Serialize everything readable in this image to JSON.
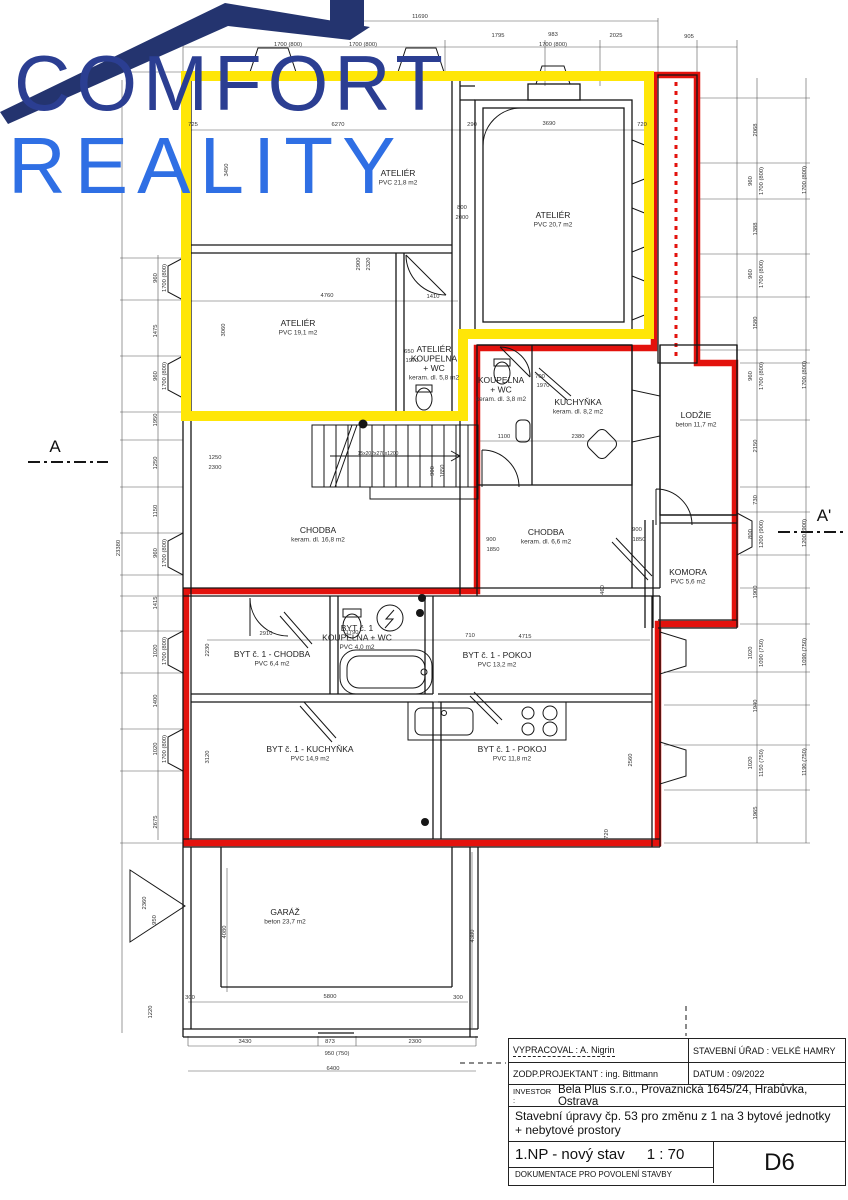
{
  "logo": {
    "line1": "COMFORT",
    "line2": "REALITY",
    "colors": {
      "comfort": "#2b3e92",
      "reality": "#2f6fe4",
      "roof": "#24346f"
    }
  },
  "highlight": {
    "yellow": "#ffe608",
    "red": "#e3120d"
  },
  "markers": {
    "left": "A",
    "right": "A'"
  },
  "rooms": [
    {
      "id": "atelier-21",
      "x": 398,
      "y": 176,
      "sub": 1,
      "lines": [
        "ATELIÉR",
        "PVC 21,8 m2"
      ]
    },
    {
      "id": "atelier-19",
      "x": 298,
      "y": 326,
      "sub": 1,
      "lines": [
        "ATELIÉR",
        "PVC 19,1 m2"
      ]
    },
    {
      "id": "atelier-20",
      "x": 553,
      "y": 218,
      "sub": 1,
      "lines": [
        "ATELIÉR",
        "PVC 20,7 m2"
      ]
    },
    {
      "id": "atelier-koupelna",
      "x": 434,
      "y": 352,
      "sub": 3,
      "lines": [
        "ATELIÉR",
        "KOUPELNA",
        "+ WC",
        "keram. dl. 5,8 m2"
      ]
    },
    {
      "id": "koupelna-wc",
      "x": 501,
      "y": 383,
      "sub": 2,
      "lines": [
        "KOUPELNA",
        "+ WC",
        "keram. dl. 3,8 m2"
      ]
    },
    {
      "id": "kuchynka",
      "x": 578,
      "y": 405,
      "sub": 1,
      "lines": [
        "KUCHYŇKA",
        "keram. dl. 8,2 m2"
      ]
    },
    {
      "id": "lodzie",
      "x": 696,
      "y": 418,
      "sub": 1,
      "lines": [
        "LODŽIE",
        "beton 11,7 m2"
      ]
    },
    {
      "id": "chodba-hlavni",
      "x": 318,
      "y": 533,
      "sub": 1,
      "lines": [
        "CHODBA",
        "keram. dl. 16,8 m2"
      ]
    },
    {
      "id": "chodba-mala",
      "x": 546,
      "y": 535,
      "sub": 1,
      "lines": [
        "CHODBA",
        "keram. dl. 6,6 m2"
      ]
    },
    {
      "id": "komora",
      "x": 688,
      "y": 575,
      "sub": 1,
      "lines": [
        "KOMORA",
        "PVC 5,6 m2"
      ]
    },
    {
      "id": "byt1-chodba",
      "x": 272,
      "y": 657,
      "sub": 1,
      "lines": [
        "BYT č. 1 - CHODBA",
        "PVC 6,4 m2"
      ]
    },
    {
      "id": "byt1-koupelna",
      "x": 357,
      "y": 631,
      "sub": 2,
      "lines": [
        "BYT č. 1",
        "KOUPELNA + WC",
        "PVC 4,0 m2"
      ]
    },
    {
      "id": "byt1-pokoj-13",
      "x": 497,
      "y": 658,
      "sub": 1,
      "lines": [
        "BYT č. 1 - POKOJ",
        "PVC 13,2 m2"
      ]
    },
    {
      "id": "byt1-kuchynka",
      "x": 310,
      "y": 752,
      "sub": 1,
      "lines": [
        "BYT č. 1 - KUCHYŇKA",
        "PVC 14,9 m2"
      ]
    },
    {
      "id": "byt1-pokoj-11",
      "x": 512,
      "y": 752,
      "sub": 1,
      "lines": [
        "BYT č. 1 - POKOJ",
        "PVC 11,8 m2"
      ]
    },
    {
      "id": "garaz",
      "x": 285,
      "y": 915,
      "sub": 1,
      "lines": [
        "GARÁŽ",
        "beton 23,7 m2"
      ]
    }
  ],
  "dims": [
    {
      "t": "11690",
      "x": 420,
      "y": 18
    },
    {
      "t": "1700 (800)",
      "x": 288,
      "y": 46
    },
    {
      "t": "1700 (800)",
      "x": 363,
      "y": 46
    },
    {
      "t": "1795",
      "x": 498,
      "y": 37
    },
    {
      "t": "983",
      "x": 553,
      "y": 36
    },
    {
      "t": "1700 (800)",
      "x": 553,
      "y": 46
    },
    {
      "t": "2025",
      "x": 616,
      "y": 37
    },
    {
      "t": "905",
      "x": 689,
      "y": 38
    },
    {
      "t": "725",
      "x": 193,
      "y": 126
    },
    {
      "t": "6270",
      "x": 338,
      "y": 126
    },
    {
      "t": "290",
      "x": 472,
      "y": 126
    },
    {
      "t": "3690",
      "x": 549,
      "y": 125
    },
    {
      "t": "720",
      "x": 642,
      "y": 126
    },
    {
      "t": "960",
      "x": 157,
      "y": 278,
      "r": 1
    },
    {
      "t": "1700 (800)",
      "x": 166,
      "y": 278,
      "r": 1
    },
    {
      "t": "1475",
      "x": 157,
      "y": 331,
      "r": 1
    },
    {
      "t": "960",
      "x": 157,
      "y": 376,
      "r": 1
    },
    {
      "t": "1700 (800)",
      "x": 166,
      "y": 376,
      "r": 1
    },
    {
      "t": "1950",
      "x": 157,
      "y": 420,
      "r": 1
    },
    {
      "t": "1250",
      "x": 157,
      "y": 463,
      "r": 1
    },
    {
      "t": "1150",
      "x": 157,
      "y": 511,
      "r": 1
    },
    {
      "t": "960",
      "x": 157,
      "y": 553,
      "r": 1
    },
    {
      "t": "1700 (800)",
      "x": 166,
      "y": 553,
      "r": 1
    },
    {
      "t": "1415",
      "x": 157,
      "y": 603,
      "r": 1
    },
    {
      "t": "1020",
      "x": 157,
      "y": 651,
      "r": 1
    },
    {
      "t": "1700 (800)",
      "x": 166,
      "y": 651,
      "r": 1
    },
    {
      "t": "1400",
      "x": 157,
      "y": 701,
      "r": 1
    },
    {
      "t": "1020",
      "x": 157,
      "y": 749,
      "r": 1
    },
    {
      "t": "1700 (800)",
      "x": 166,
      "y": 749,
      "r": 1
    },
    {
      "t": "2675",
      "x": 157,
      "y": 822,
      "r": 1
    },
    {
      "t": "23380",
      "x": 120,
      "y": 548,
      "r": 1
    },
    {
      "t": "3450",
      "x": 228,
      "y": 170,
      "r": 1
    },
    {
      "t": "3060",
      "x": 225,
      "y": 330,
      "r": 1
    },
    {
      "t": "2068",
      "x": 757,
      "y": 130,
      "r": 1
    },
    {
      "t": "960",
      "x": 752,
      "y": 181,
      "r": 1
    },
    {
      "t": "1700 (800)",
      "x": 763,
      "y": 181,
      "r": 1
    },
    {
      "t": "1388",
      "x": 757,
      "y": 229,
      "r": 1
    },
    {
      "t": "960",
      "x": 752,
      "y": 274,
      "r": 1
    },
    {
      "t": "1700 (800)",
      "x": 763,
      "y": 274,
      "r": 1
    },
    {
      "t": "1580",
      "x": 757,
      "y": 323,
      "r": 1
    },
    {
      "t": "960",
      "x": 752,
      "y": 376,
      "r": 1
    },
    {
      "t": "1700 (800)",
      "x": 763,
      "y": 376,
      "r": 1
    },
    {
      "t": "2150",
      "x": 757,
      "y": 446,
      "r": 1
    },
    {
      "t": "730",
      "x": 757,
      "y": 500,
      "r": 1
    },
    {
      "t": "800",
      "x": 752,
      "y": 534,
      "r": 1
    },
    {
      "t": "1200 (900)",
      "x": 763,
      "y": 534,
      "r": 1
    },
    {
      "t": "1900",
      "x": 757,
      "y": 592,
      "r": 1
    },
    {
      "t": "1020",
      "x": 752,
      "y": 653,
      "r": 1
    },
    {
      "t": "1090 (750)",
      "x": 763,
      "y": 653,
      "r": 1
    },
    {
      "t": "1940",
      "x": 757,
      "y": 706,
      "r": 1
    },
    {
      "t": "1020",
      "x": 752,
      "y": 763,
      "r": 1
    },
    {
      "t": "1150 (750)",
      "x": 763,
      "y": 763,
      "r": 1
    },
    {
      "t": "1965",
      "x": 757,
      "y": 813,
      "r": 1
    },
    {
      "t": "1700 (800)",
      "x": 806,
      "y": 180,
      "r": 1
    },
    {
      "t": "1700 (800)",
      "x": 806,
      "y": 375,
      "r": 1
    },
    {
      "t": "1200 (900)",
      "x": 806,
      "y": 533,
      "r": 1
    },
    {
      "t": "1090 (750)",
      "x": 806,
      "y": 652,
      "r": 1
    },
    {
      "t": "1190 (750)",
      "x": 806,
      "y": 762,
      "r": 1
    },
    {
      "t": "4760",
      "x": 327,
      "y": 297
    },
    {
      "t": "1410",
      "x": 433,
      "y": 298
    },
    {
      "t": "800",
      "x": 462,
      "y": 209
    },
    {
      "t": "2000",
      "x": 462,
      "y": 219
    },
    {
      "t": "2900",
      "x": 360,
      "y": 264,
      "r": 1
    },
    {
      "t": "2320",
      "x": 370,
      "y": 264,
      "r": 1
    },
    {
      "t": "650",
      "x": 409,
      "y": 353
    },
    {
      "t": "1970",
      "x": 412,
      "y": 362
    },
    {
      "t": "700",
      "x": 540,
      "y": 378
    },
    {
      "t": "1970",
      "x": 543,
      "y": 387
    },
    {
      "t": "1100",
      "x": 504,
      "y": 438
    },
    {
      "t": "2380",
      "x": 578,
      "y": 438
    },
    {
      "t": "1250",
      "x": 215,
      "y": 459
    },
    {
      "t": "2300",
      "x": 215,
      "y": 469
    },
    {
      "t": "900",
      "x": 434,
      "y": 471,
      "r": 1
    },
    {
      "t": "1850",
      "x": 444,
      "y": 471,
      "r": 1
    },
    {
      "t": "900",
      "x": 491,
      "y": 541
    },
    {
      "t": "1850",
      "x": 493,
      "y": 551
    },
    {
      "t": "900",
      "x": 637,
      "y": 531
    },
    {
      "t": "1850",
      "x": 639,
      "y": 541
    },
    {
      "t": "2910",
      "x": 266,
      "y": 635
    },
    {
      "t": "1790",
      "x": 352,
      "y": 634
    },
    {
      "t": "710",
      "x": 470,
      "y": 637
    },
    {
      "t": "4715",
      "x": 525,
      "y": 638
    },
    {
      "t": "460",
      "x": 604,
      "y": 590,
      "r": 1
    },
    {
      "t": "2560",
      "x": 632,
      "y": 760,
      "r": 1
    },
    {
      "t": "720",
      "x": 608,
      "y": 834,
      "r": 1
    },
    {
      "t": "2230",
      "x": 209,
      "y": 650,
      "r": 1
    },
    {
      "t": "3120",
      "x": 209,
      "y": 757,
      "r": 1
    },
    {
      "t": "2360",
      "x": 146,
      "y": 903,
      "r": 1
    },
    {
      "t": "950",
      "x": 156,
      "y": 920,
      "r": 1
    },
    {
      "t": "4080",
      "x": 226,
      "y": 932,
      "r": 1
    },
    {
      "t": "4380",
      "x": 474,
      "y": 936,
      "r": 1
    },
    {
      "t": "1220",
      "x": 152,
      "y": 1012,
      "r": 1
    },
    {
      "t": "300",
      "x": 190,
      "y": 999
    },
    {
      "t": "5800",
      "x": 330,
      "y": 998
    },
    {
      "t": "300",
      "x": 458,
      "y": 999
    },
    {
      "t": "3430",
      "x": 245,
      "y": 1043
    },
    {
      "t": "873",
      "x": 330,
      "y": 1043
    },
    {
      "t": "950 (750)",
      "x": 337,
      "y": 1055
    },
    {
      "t": "2300",
      "x": 415,
      "y": 1043
    },
    {
      "t": "6400",
      "x": 333,
      "y": 1070
    }
  ],
  "stair_label": "15x202x270x1200",
  "title_block": {
    "vypracoval": "VYPRACOVAL : A. Nigrin",
    "stavebni_urad": "STAVEBNÍ ÚŘAD : VELKÉ HAMRY",
    "zodp_projektant": "ZODP.PROJEKTANT : ing. Bittmann",
    "datum": "DATUM : 09/2022",
    "investor_label": "INVESTOR :",
    "investor": "Bela Plus s.r.o., Provaznická 1645/24, Hrabůvka, Ostrava",
    "popis_1": "Stavební úpravy čp. 53 pro změnu z 1 na 3 bytové  jednotky",
    "popis_2": "+ nebytové prostory",
    "vykres": "1.NP - nový stav",
    "meritko": "1 : 70",
    "doc_type": "DOKUMENTACE PRO POVOLENÍ STAVBY",
    "cislo": "D6"
  }
}
